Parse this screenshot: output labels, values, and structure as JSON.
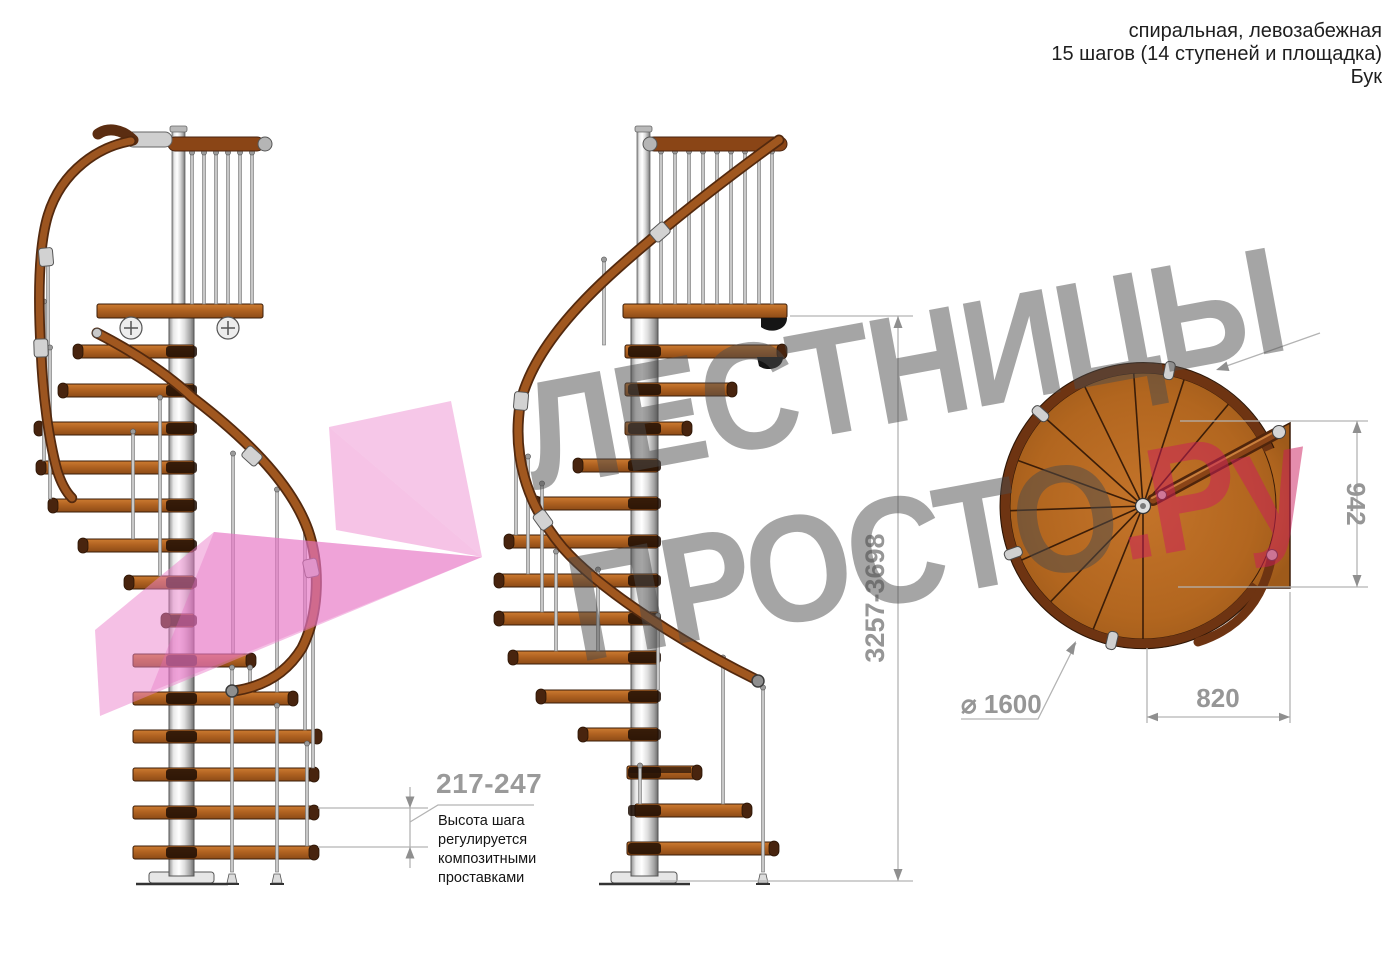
{
  "title_block": {
    "type_line": "спиральная, левозабежная",
    "steps_line": "15 шагов (14 ступеней и площадка)",
    "material_line": "Бук"
  },
  "watermark": {
    "word1": "ЛЕСТНИЦЫ",
    "word2": "ПРОСТО",
    "domain_suffix": ".Ру"
  },
  "dimensions": {
    "step_height_range": "217-247",
    "step_height_note": "Высота шага\nрегулируется\nкомпозитными\nпроставками",
    "total_height_range": "3257-3698",
    "landing_width": "942",
    "landing_depth": "820",
    "diameter_label": "⌀ 1600"
  },
  "colors": {
    "wood": "#b06622",
    "wood_dark": "#48240e",
    "rail": "#9c5520",
    "metal": "#c9c9c9",
    "dimension_gray": "#9a9a9a",
    "watermark_gray": "rgba(75,75,75,0.5)",
    "brand_pink": "rgba(203,28,92,0.5)",
    "logo_pink": "#ec82cb"
  }
}
